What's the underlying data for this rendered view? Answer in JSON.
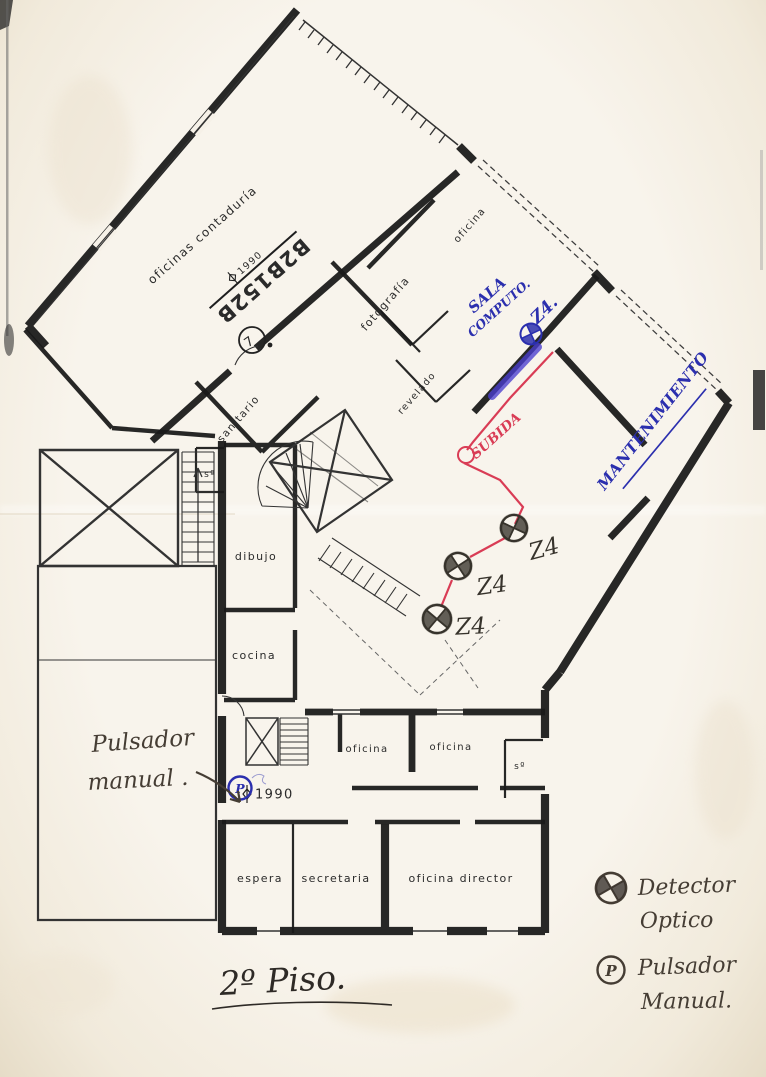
{
  "document": {
    "kind": "Scanned fire-alarm floor plan",
    "title": "2º Piso."
  },
  "rooms": [
    {
      "label": "oficinas contaduría"
    },
    {
      "label": "oficina"
    },
    {
      "label": "fotografía"
    },
    {
      "label": "revelado"
    },
    {
      "label": "sanitario"
    },
    {
      "label": "sº"
    },
    {
      "label": "dibujo"
    },
    {
      "label": "cocina"
    },
    {
      "label": "oficina"
    },
    {
      "label": "oficina"
    },
    {
      "label": "sº"
    },
    {
      "label": "espera"
    },
    {
      "label": "secretaria"
    },
    {
      "label": "oficina director"
    }
  ],
  "markers": {
    "stamp": "B2B152B",
    "level_upper": "1990",
    "level_lower": "1990",
    "circled_digit": "7"
  },
  "annotations": {
    "blue": {
      "sala_line1": "SALA",
      "sala_line2": "COMPUTO.",
      "zone": "Z4.",
      "mantenimiento": "MANTENIMIENTO",
      "pulsador_symbol": "P"
    },
    "red": {
      "subida": "SUBIDA"
    },
    "pencil": {
      "zone_labels": [
        "Z4",
        "Z4",
        "Z4"
      ],
      "note_line1": "Pulsador",
      "note_line2": "manual ."
    }
  },
  "legend": {
    "detector_symbol": "optical-detector",
    "detector_line1": "Detector",
    "detector_line2": "Optico",
    "pulsador_symbol": "P",
    "pulsador_line1": "Pulsador",
    "pulsador_line2": "Manual."
  },
  "title": {
    "text": "2º Piso.",
    "underlined": true
  },
  "colors": {
    "paper": "#f6f1e8",
    "ink": "#1a1a1a",
    "blue_pen": "#2b2fae",
    "red_pen": "#d93c55",
    "pencil": "#37332c"
  }
}
